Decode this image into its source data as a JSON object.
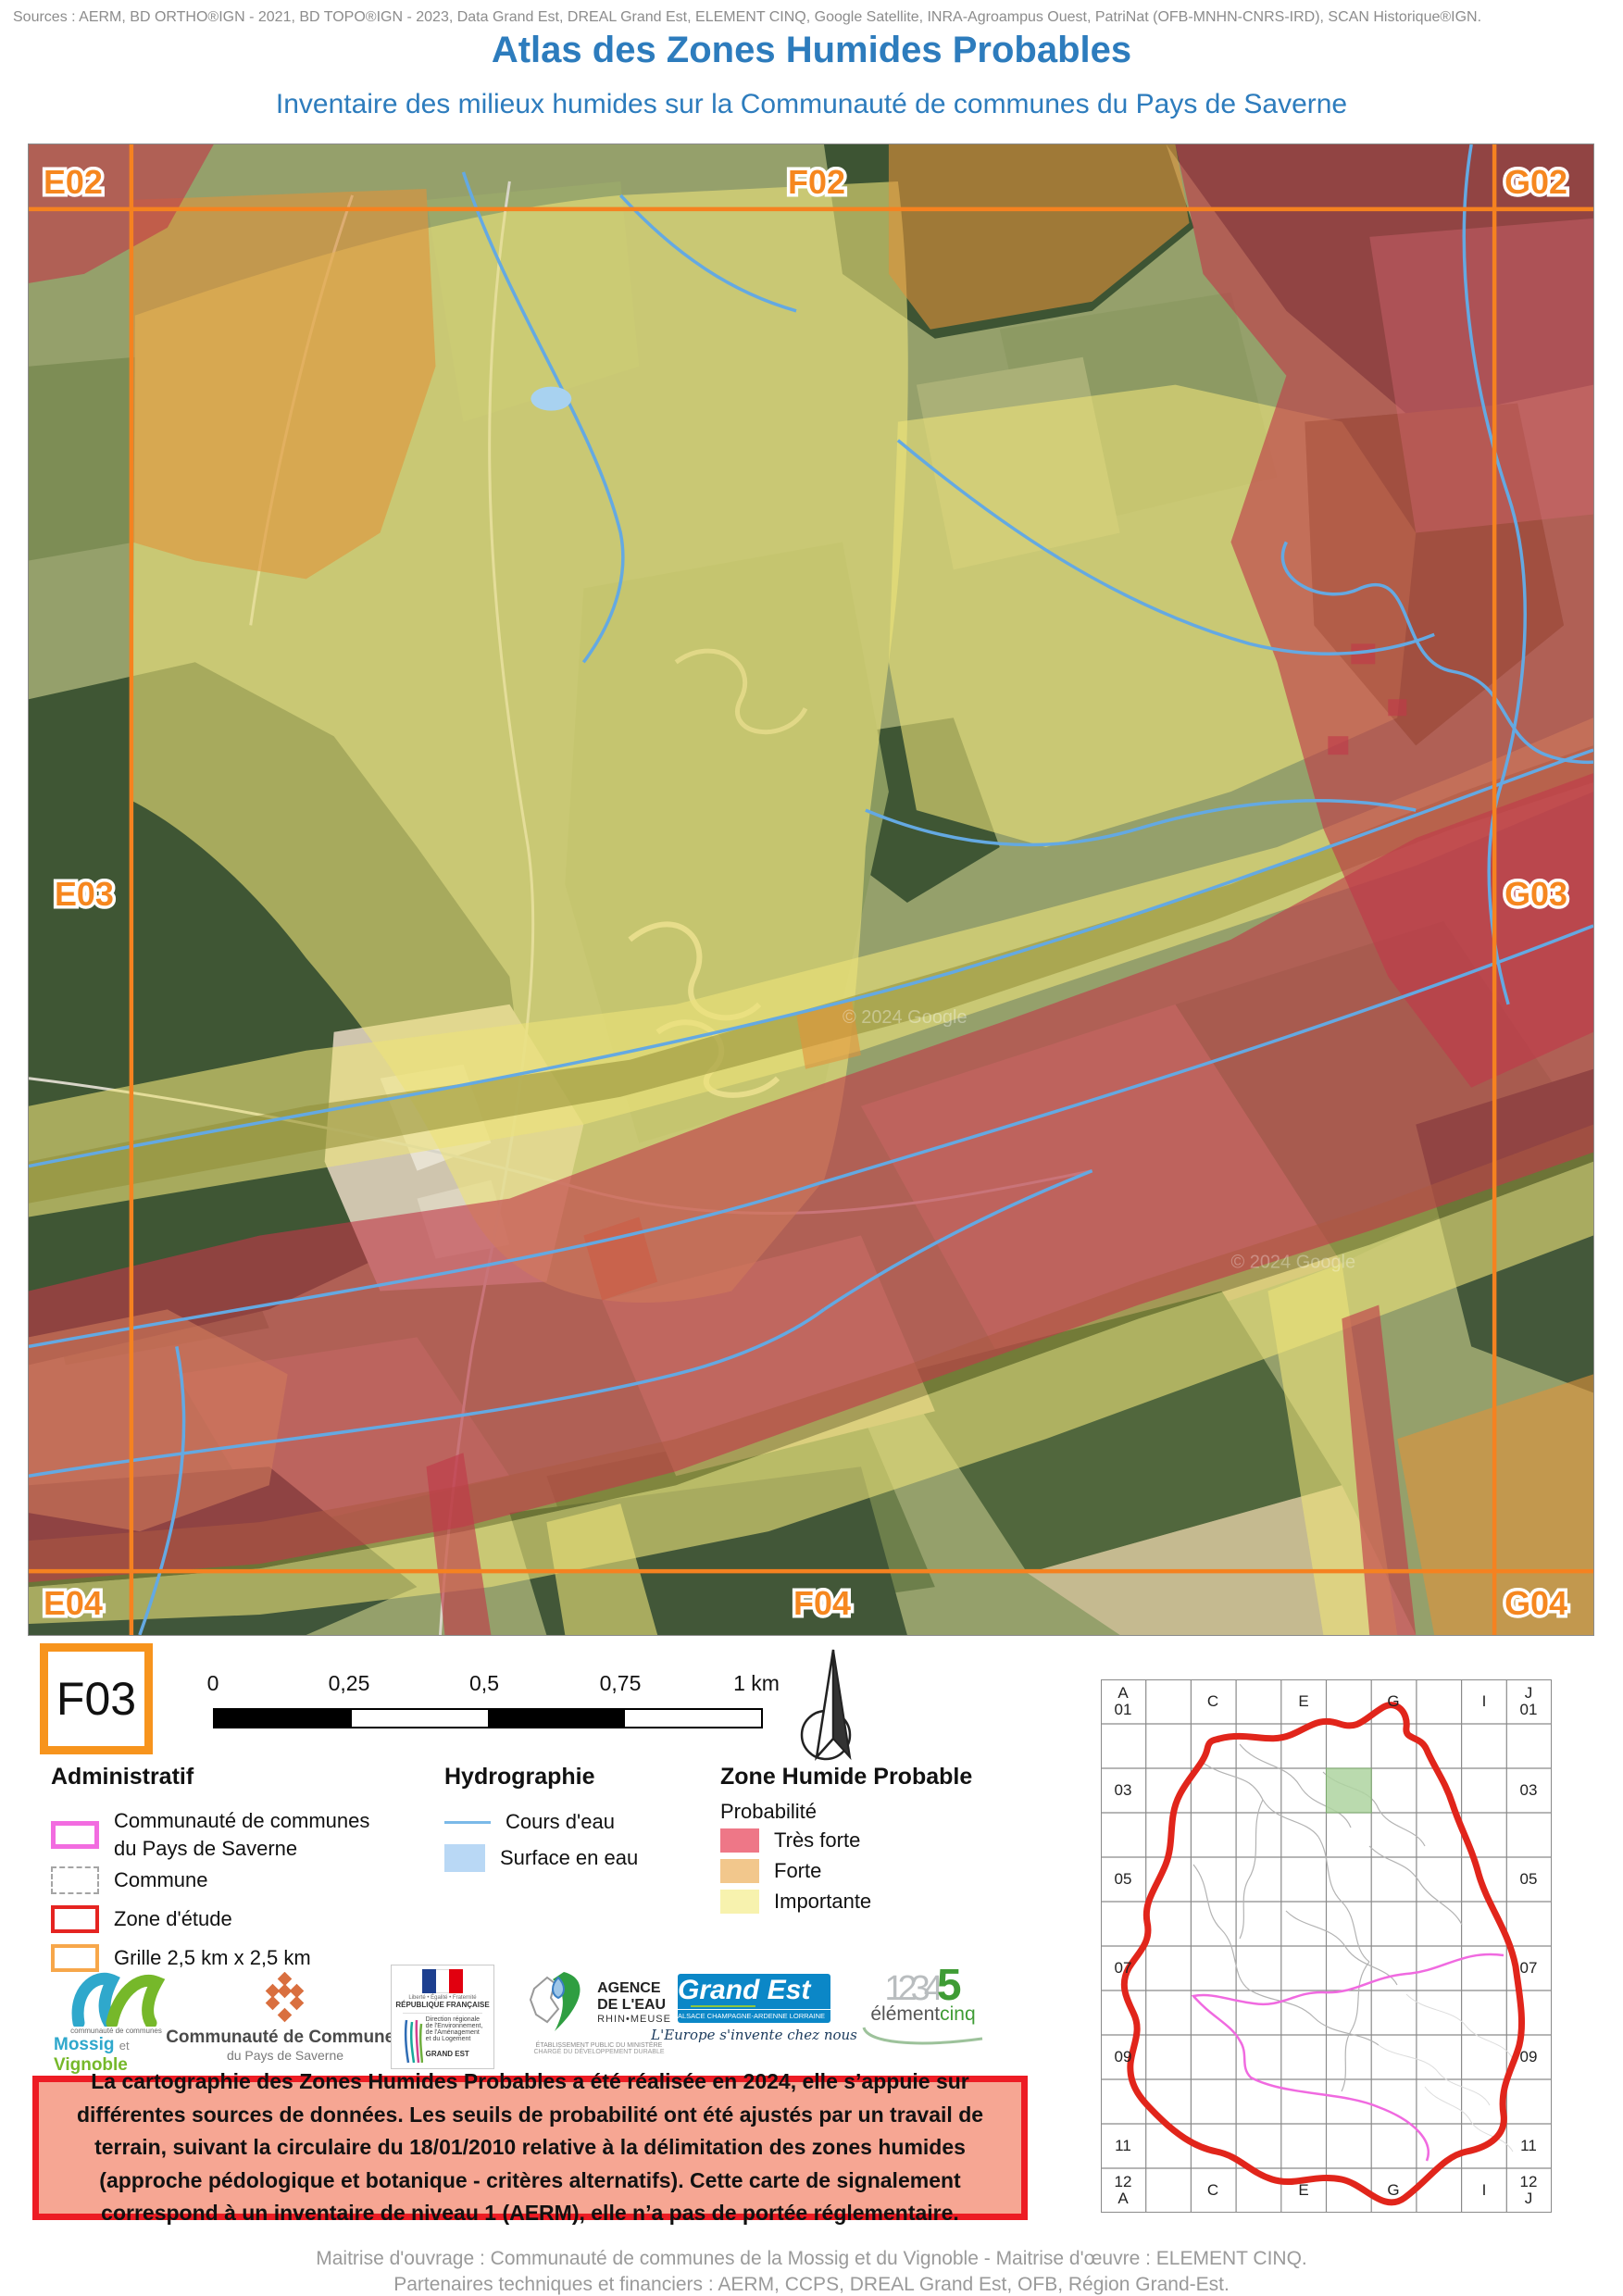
{
  "header": {
    "sources": "Sources : AERM, BD ORTHO®IGN - 2021, BD TOPO®IGN - 2023, Data Grand Est, DREAL Grand Est, ELEMENT CINQ, Google Satellite, INRA-Agroampus Ouest, PatriNat (OFB-MNHN-CNRS-IRD), SCAN Historique®IGN.",
    "title": "Atlas des Zones Humides Probables",
    "subtitle": "Inventaire des milieux humides sur la Communauté de communes du Pays de Saverne",
    "accent_color": "#2d7cbd"
  },
  "map": {
    "tile_id": "F03",
    "grid_labels": [
      "E02",
      "F02",
      "G02",
      "E03",
      "G03",
      "E04",
      "F04",
      "G04"
    ],
    "watermark": "© 2024 Google",
    "grid_color": "#f58220",
    "stream_color": "#64a9e2"
  },
  "scalebar": {
    "ticks": [
      "0",
      "0,25",
      "0,5",
      "0,75",
      "1 km"
    ]
  },
  "legend": {
    "administratif": {
      "title": "Administratif",
      "items": [
        {
          "label_line1": "Communauté de communes",
          "label_line2": "du Pays de Saverne",
          "color": "#f26ce0"
        },
        {
          "label": "Commune",
          "color": "#a5a5a5"
        },
        {
          "label": "Zone d'étude",
          "color": "#e52421"
        },
        {
          "label": "Grille 2,5 km x 2,5 km",
          "color": "#f7a74a"
        }
      ]
    },
    "hydrographie": {
      "title": "Hydrographie",
      "items": [
        {
          "label": "Cours d'eau",
          "color": "#7ab9e8"
        },
        {
          "label": "Surface en eau",
          "color": "#b9d8f5"
        }
      ]
    },
    "zone_humide": {
      "title": "Zone Humide Probable",
      "subtitle": "Probabilité",
      "items": [
        {
          "label": "Très forte",
          "color": "#ee7787"
        },
        {
          "label": "Forte",
          "color": "#f2c78c"
        },
        {
          "label": "Importante",
          "color": "#f7f2ae"
        }
      ]
    }
  },
  "logos": {
    "mossig": {
      "line0": "communauté de communes",
      "name1": "Mossig",
      "name_et": "et",
      "name2": "Vignoble",
      "region": "Alsace"
    },
    "saverne": {
      "name": "Communauté de Communes",
      "sub": "du Pays de Saverne"
    },
    "republique": {
      "motto": "Liberté • Égalité • Fraternité",
      "name": "RÉPUBLIQUE FRANÇAISE",
      "dir1": "Direction régionale",
      "dir2": "de l'Environnement,",
      "dir3": "de l'Aménagement",
      "dir4": "et du Logement",
      "region": "GRAND EST"
    },
    "agence_eau": {
      "name1": "AGENCE",
      "name2": "DE L'EAU",
      "name3": "RHIN•MEUSE",
      "sub1": "ÉTABLISSEMENT PUBLIC DU MINISTÈRE",
      "sub2": "CHARGÉ DU DÉVELOPPEMENT DURABLE"
    },
    "grand_est": {
      "name": "Grand Est",
      "strip": "ALSACE CHAMPAGNE-ARDENNE LORRAINE",
      "tagline": "L'Europe s'invente chez nous"
    },
    "element_cinq": {
      "numbers": "1234",
      "five": "5",
      "name1": "élément",
      "name2": "cinq"
    }
  },
  "disclaimer": {
    "text": "La cartographie des Zones Humides Probables a été réalisée en 2024, elle s’appuie sur différentes sources de données. Les seuils de probabilité ont été ajustés par un travail de terrain, suivant la circulaire du 18/01/2010 relative à la délimitation des zones humides (approche pédologique et botanique - critères alternatifs). Cette carte de signalement correspond à un inventaire de niveau 1 (AERM), elle n’a pas de portée réglementaire."
  },
  "overview": {
    "col_labels": [
      "C",
      "E",
      "G",
      "I"
    ],
    "row_labels": [
      "03",
      "05",
      "07",
      "09",
      "11"
    ],
    "corner_tl": [
      "A",
      "01"
    ],
    "corner_tr": [
      "J",
      "01"
    ],
    "corner_bl": [
      "12",
      "A"
    ],
    "corner_br": [
      "12",
      "J"
    ],
    "highlight_cell": "F03",
    "boundary_color": "#e1251b",
    "cc_color": "#f06ae0"
  },
  "footer": {
    "line1": "Maitrise d'ouvrage : Communauté de communes de la Mossig et du Vignoble - Maitrise d'œuvre : ELEMENT CINQ.",
    "line2": "Partenaires techniques et financiers : AERM, CCPS, DREAL Grand Est, OFB, Région Grand-Est."
  }
}
